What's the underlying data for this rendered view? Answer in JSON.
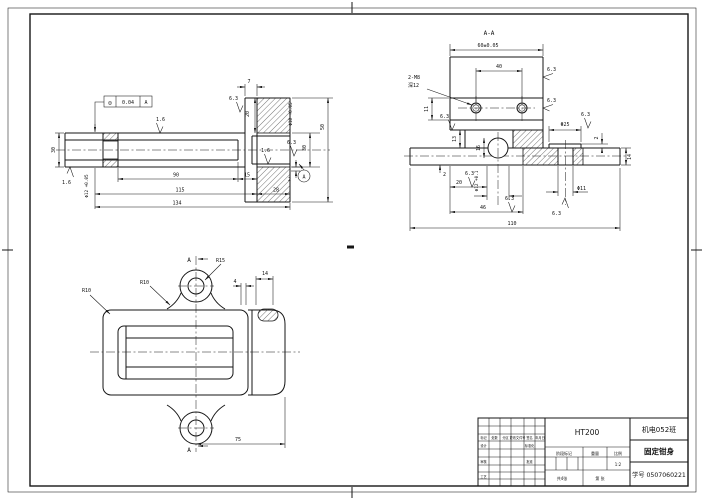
{
  "front": {
    "fcf": {
      "symbol": "◎",
      "value": "0.04",
      "datum": "A"
    },
    "datum_label": "A",
    "dims": {
      "d7": "7",
      "d20": "20",
      "d30_left": "30",
      "phi12": "Φ12 +0.05",
      "d90": "90",
      "d15": "15",
      "d115": "115",
      "d134": "134",
      "d28": "28",
      "d2": "2",
      "phi18": "Φ18 +0.05",
      "d30_right": "30",
      "d50": "50"
    },
    "roughness": {
      "top": "1.6",
      "bottom_left": "1.6",
      "groove": "6.3",
      "bore": "1.6",
      "bore2": "6.3"
    }
  },
  "section": {
    "label": "A-A",
    "dims": {
      "d60": "60±0.05",
      "d40": "40",
      "thread": "2-M8",
      "thread_depth": "深12",
      "d11": "11",
      "d13": "13",
      "d16": "16",
      "d2_left": "2",
      "d20": "20",
      "d46": "46",
      "d110": "110",
      "phi12": "Φ12 +0.1",
      "phi25": "Φ25",
      "d2_right": "2",
      "d14": "14",
      "phi11": "Φ11"
    },
    "roughness": {
      "r1": "6.3",
      "r2": "6.3",
      "r3": "6.3",
      "r4": "6.3",
      "r5": "6.3",
      "r6": "6.3",
      "r7": "6.3"
    }
  },
  "plan": {
    "section_arrow_top": "A",
    "section_arrow_bottom": "A",
    "dims": {
      "r15": "R15",
      "r10_fillet": "R10",
      "r10_corner": "R10",
      "d4": "4",
      "d14": "14",
      "d75": "75"
    }
  },
  "title_block": {
    "class_name": "机电052班",
    "material": "HT200",
    "part_name": "固定钳身",
    "student_id": "学号 0507060221",
    "cells": {
      "mark": "标记",
      "count": "处数",
      "zone": "分区",
      "change_doc": "更改文件号",
      "signature": "签名",
      "date": "年月日",
      "design": "设计",
      "standardization": "标准化",
      "review": "审核",
      "approve": "批准",
      "process": "工艺",
      "stage_mark": "阶段标记",
      "weight": "重量",
      "scale_label": "比例",
      "scale": "1:2",
      "sheets_total": "共4张",
      "sheet_no": "第 张"
    }
  }
}
